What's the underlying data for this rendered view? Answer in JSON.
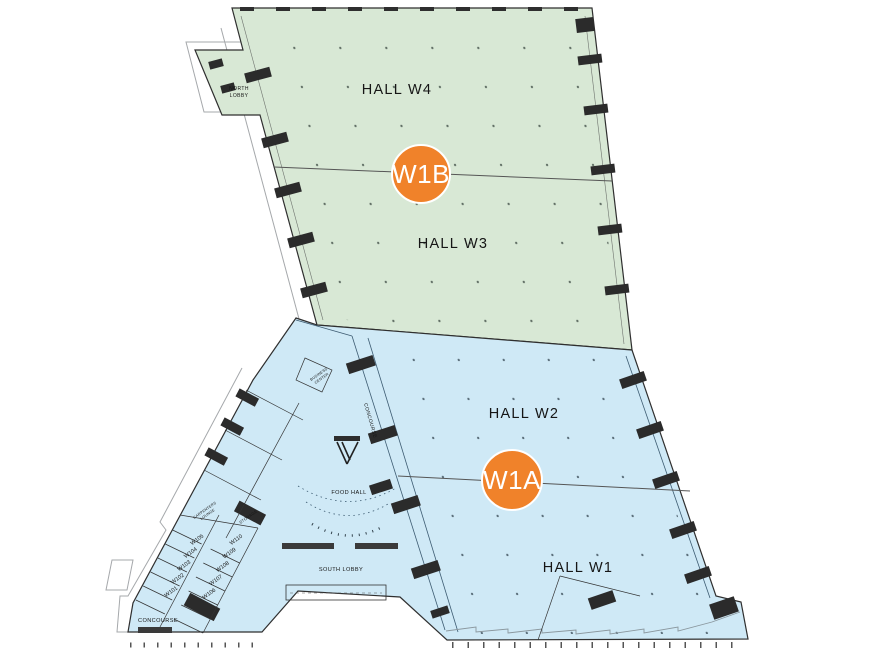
{
  "colors": {
    "zone_upper": "#d8e8d5",
    "zone_lower": "#cfe9f6",
    "marker": "#f0822a",
    "outline": "#2f2f2f"
  },
  "markers": {
    "upper": {
      "label": "W1B"
    },
    "lower": {
      "label": "W1A"
    }
  },
  "halls": {
    "w4": {
      "label": "HALL W4"
    },
    "w3": {
      "label": "HALL W3"
    },
    "w2": {
      "label": "HALL W2"
    },
    "w1": {
      "label": "HALL W1"
    }
  },
  "labels": {
    "north_lobby": [
      "NORTH",
      "LOBBY"
    ],
    "south_lobby": "SOUTH LOBBY",
    "food_hall": "FOOD HALL",
    "concourse_sw": "CONCOURSE",
    "concourse_center": "CONCOURSE",
    "storage": "STORAGE",
    "carpenters_lounge": [
      "CARPENTERS",
      "LOUNGE"
    ],
    "business_center": [
      "BUSINESS",
      "CENTER"
    ]
  },
  "rooms": [
    {
      "label": "W101"
    },
    {
      "label": "W102"
    },
    {
      "label": "W103"
    },
    {
      "label": "W104"
    },
    {
      "label": "W105"
    },
    {
      "label": "W106"
    },
    {
      "label": "W107"
    },
    {
      "label": "W108"
    },
    {
      "label": "W109"
    },
    {
      "label": "W110"
    }
  ]
}
